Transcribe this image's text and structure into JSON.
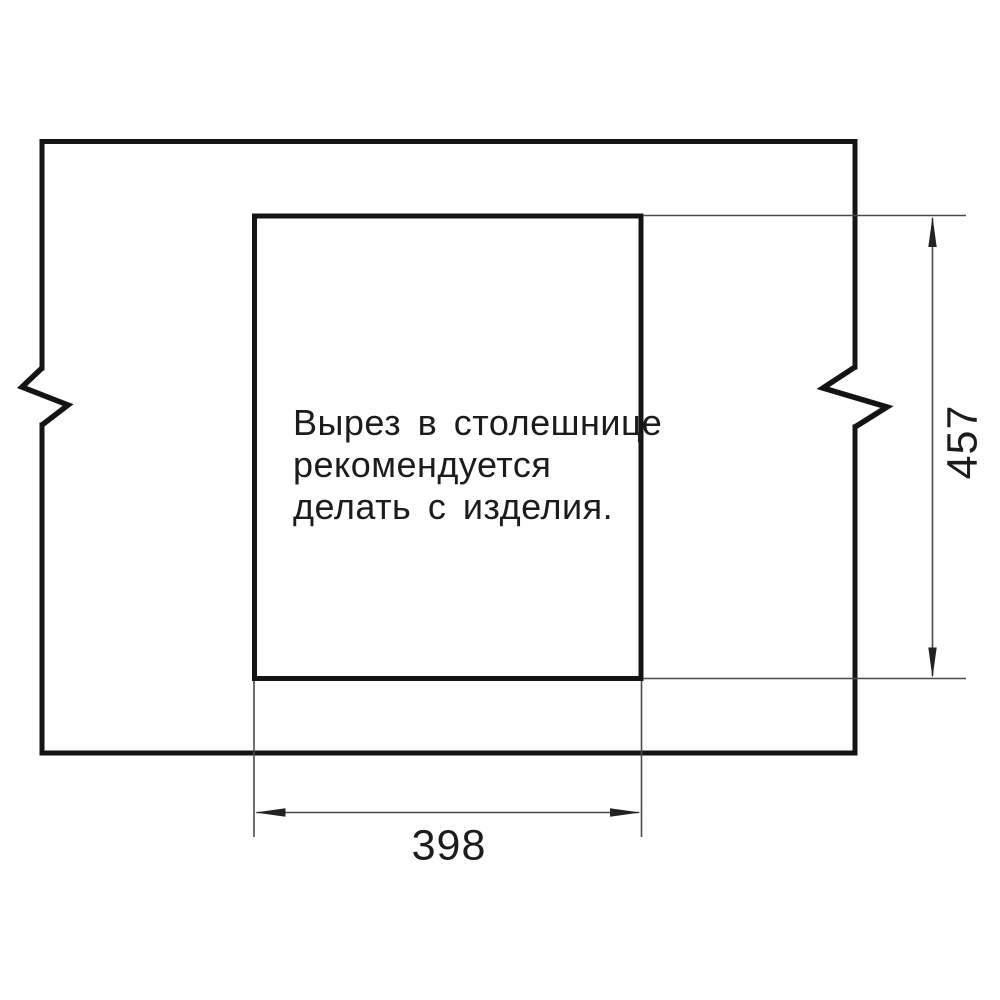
{
  "drawing": {
    "note": {
      "line1": "Вырез в столешнице",
      "line2": "рекомендуется",
      "line3": "делать с изделия."
    },
    "dimensions": {
      "cutout_width": "398",
      "cutout_height": "457"
    },
    "symbols": {
      "break_mark_left": "zigzag-break",
      "break_mark_right": "zigzag-break"
    },
    "colors": {
      "outline": "#141414",
      "dimension_lines": "#4a4a4a",
      "arrows": "#222222",
      "text": "#1c1c1c",
      "background": "#ffffff"
    }
  }
}
